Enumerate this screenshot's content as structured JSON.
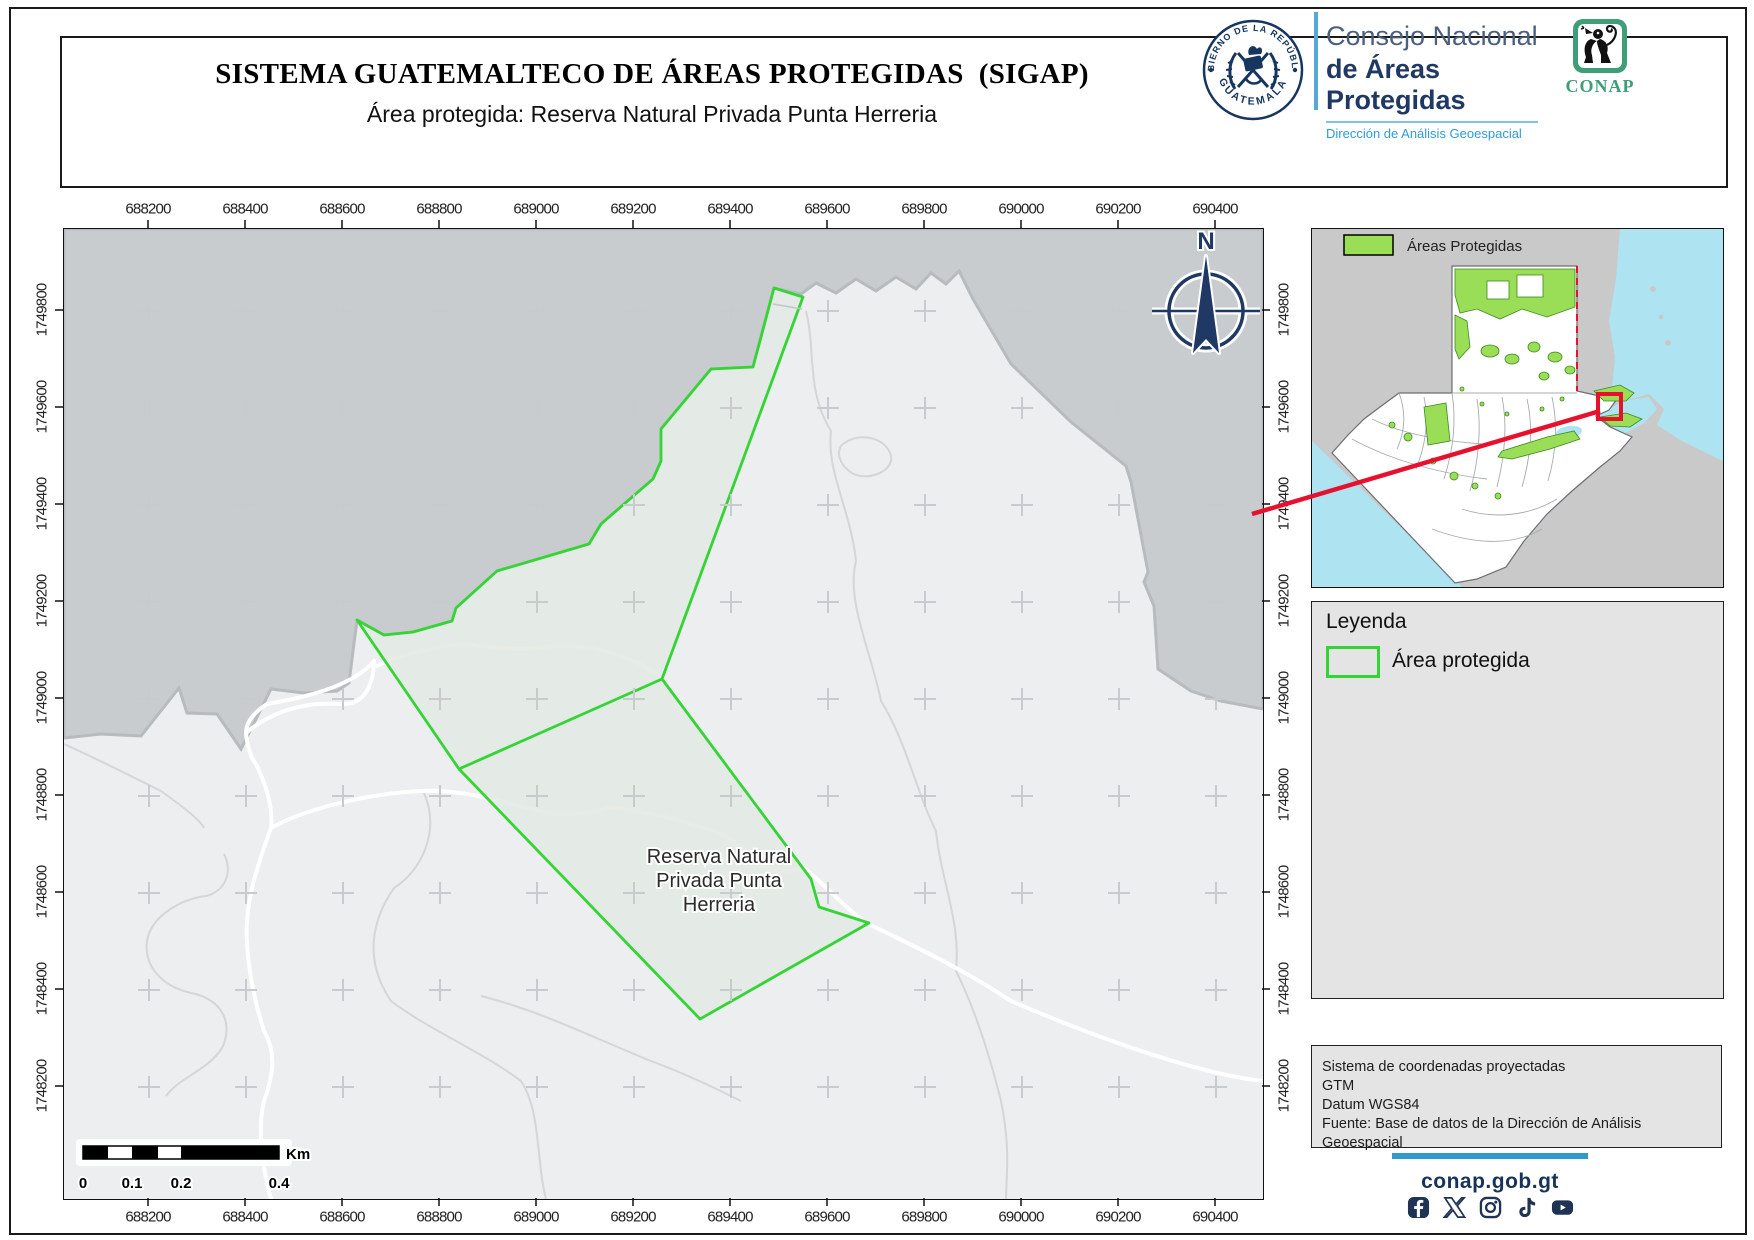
{
  "header": {
    "title": "SISTEMA GUATEMALTECO DE ÁREAS PROTEGIDAS  (SIGAP)",
    "subtitle": "Área protegida: Reserva Natural Privada Punta Herreria",
    "seal_top": "GOBIERNO DE LA REPÚBLICA",
    "seal_bottom": "GUATEMALA",
    "consejo_line1": "Consejo Nacional",
    "consejo_line2": "de Áreas Protegidas",
    "consejo_line3": "Dirección de Análisis Geoespacial",
    "conap": "CONAP"
  },
  "map": {
    "x_ticks": [
      "688200",
      "688400",
      "688600",
      "688800",
      "689000",
      "689200",
      "689400",
      "689600",
      "689800",
      "690000",
      "690200",
      "690400"
    ],
    "y_ticks": [
      "1749800",
      "1749600",
      "1749400",
      "1749200",
      "1749000",
      "1748800",
      "1748600",
      "1748400",
      "1748200"
    ],
    "compass_n": "N",
    "reserve_label_lines": [
      "Reserva Natural",
      "Privada Punta",
      "Herreria"
    ],
    "scale": {
      "labels": [
        "0",
        "0.1",
        "0.2",
        "0.4"
      ],
      "unit": "Km"
    }
  },
  "inset": {
    "legend_label": "Áreas Protegidas"
  },
  "legend": {
    "title": "Leyenda",
    "item": "Área protegida"
  },
  "info": {
    "lines": [
      "Sistema de coordenadas proyectadas",
      "GTM",
      "Datum WGS84",
      "Fuente: Base de datos de la Dirección de Análisis Geoespacial"
    ]
  },
  "footer": {
    "url": "conap.gob.gt",
    "icons": [
      "facebook-icon",
      "x-icon",
      "instagram-icon",
      "tiktok-icon",
      "youtube-icon"
    ]
  },
  "colors": {
    "reserve_green": "#35d435",
    "water_gray": "#c8ccce",
    "land_gray": "#eceeef",
    "navy": "#1f3864",
    "inset_green": "#9ade57",
    "sea_cyan": "#aee4f2",
    "red_marker": "#e8112d",
    "footer_blue": "#2e9ad0"
  }
}
